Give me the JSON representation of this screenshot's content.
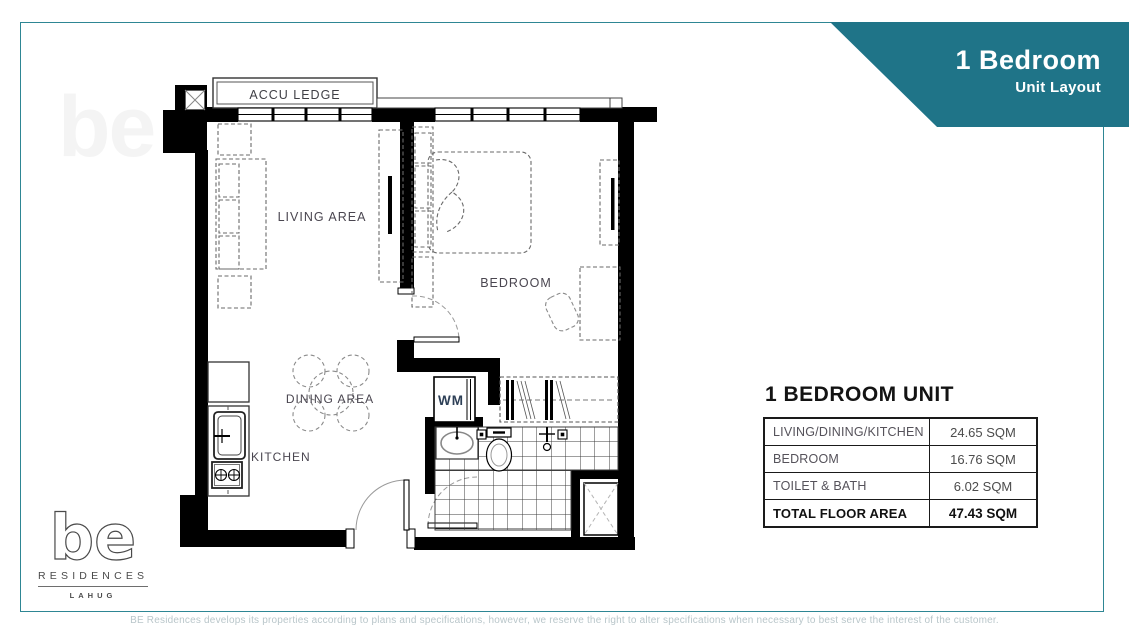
{
  "banner": {
    "title": "1 Bedroom",
    "subtitle": "Unit Layout"
  },
  "plan": {
    "labels": {
      "accu_ledge": "ACCU LEDGE",
      "living_area": "LIVING AREA",
      "bedroom": "BEDROOM",
      "dining_area": "DINING AREA",
      "kitchen": "KITCHEN",
      "wm": "WM"
    }
  },
  "unit_table": {
    "title": "1 BEDROOM UNIT",
    "rows": [
      {
        "label": "LIVING/DINING/KITCHEN",
        "value": "24.65 SQM"
      },
      {
        "label": "BEDROOM",
        "value": "16.76 SQM"
      },
      {
        "label": "TOILET & BATH",
        "value": "6.02 SQM"
      },
      {
        "label": "TOTAL FLOOR AREA",
        "value": "47.43 SQM"
      }
    ]
  },
  "logo": {
    "mark": "be",
    "name": "RESIDENCES",
    "location": "LAHUG"
  },
  "footer": {
    "disclaimer": "BE Residences develops its properties according to plans and specifications, however, we reserve the right to alter specifications when necessary to best serve the interest of the customer."
  },
  "colors": {
    "teal_banner": "#1f7488",
    "teal_border": "#2e8694"
  }
}
